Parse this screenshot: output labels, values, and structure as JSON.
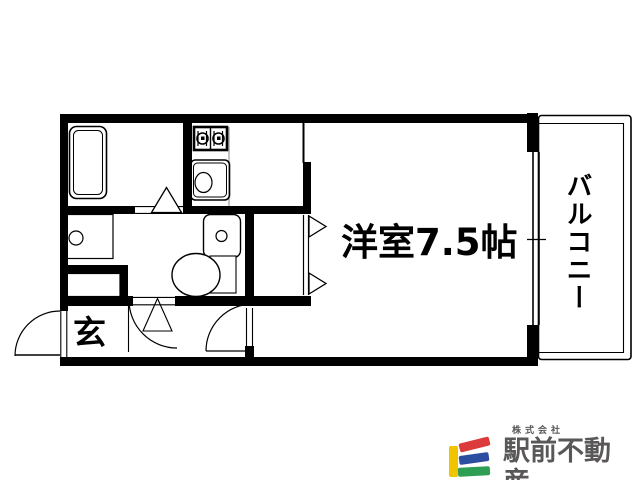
{
  "floor_plan": {
    "room_labels": {
      "main_room": "洋室7.5帖",
      "balcony": "バルコニー",
      "entrance": "玄"
    },
    "fixtures": [
      "bathtub",
      "gas-stove",
      "kitchen-sink",
      "washing-machine-pan",
      "shoe-cabinet",
      "toilet",
      "window",
      "entry-door",
      "room-door",
      "washroom-door",
      "bath-folding-door",
      "closet-folding-door"
    ],
    "branding": {
      "company_prefix": "株式会社",
      "company_name": "駅前不動産",
      "logo_colors": {
        "yellow": "#F1C400",
        "red": "#DD3B3B",
        "blue": "#2C4EA0",
        "green": "#2E9E52"
      },
      "text_color": "#595757"
    },
    "line_color": "#000000",
    "background_color": "#FFFFFF"
  }
}
